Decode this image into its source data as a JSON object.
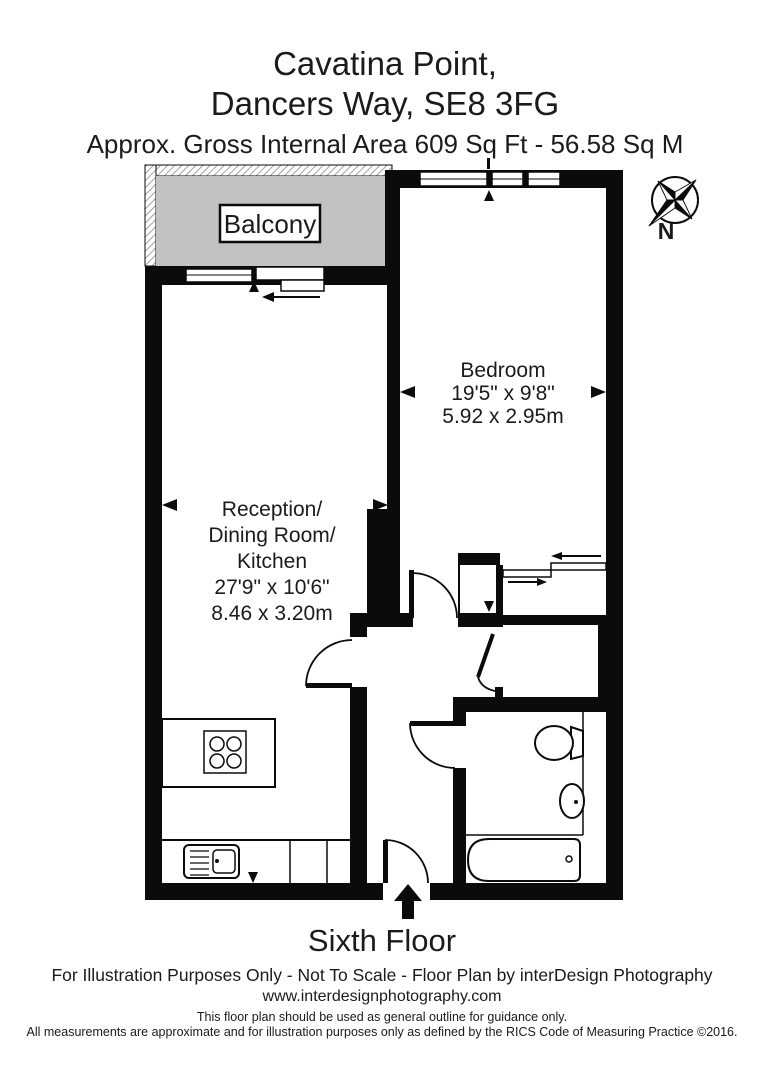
{
  "header": {
    "building": "Cavatina Point,",
    "address": "Dancers Way, SE8 3FG",
    "area": "Approx. Gross Internal Area  609 Sq Ft  -  56.58 Sq M"
  },
  "plan": {
    "balcony": {
      "label": "Balcony"
    },
    "bedroom": {
      "name": "Bedroom",
      "size_imperial": "19'5\" x 9'8\"",
      "size_metric": "5.92 x 2.95m"
    },
    "reception": {
      "name1": "Reception/",
      "name2": "Dining Room/",
      "name3": "Kitchen",
      "size_imperial": "27'9\" x 10'6\"",
      "size_metric": "8.46 x 3.20m"
    },
    "floor": "Sixth Floor",
    "compass": "N",
    "colors": {
      "wall": "#0b0b0b",
      "balcony_fill": "#c2c2c2",
      "floor": "#ffffff"
    }
  },
  "footer": {
    "line1": "For Illustration Purposes Only - Not To Scale - Floor Plan by interDesign Photography",
    "line2": "www.interdesignphotography.com",
    "line3": "This floor plan should be used as general outline for guidance only.",
    "line4": "All measurements are approximate and for illustration purposes only as defined by the RICS Code of Measuring Practice ©2016."
  }
}
